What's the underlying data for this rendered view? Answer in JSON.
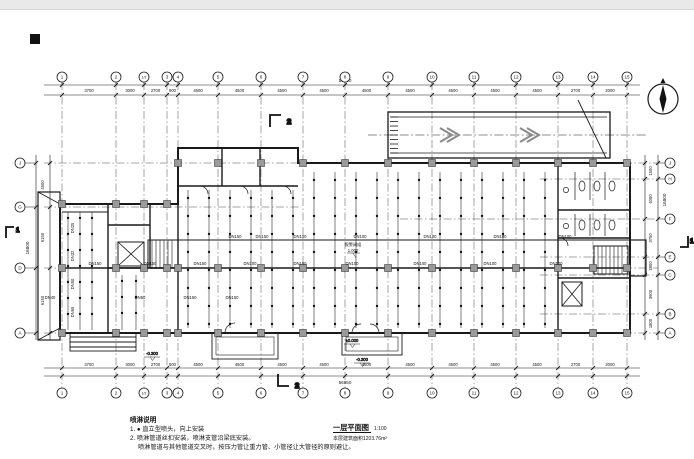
{
  "colors": {
    "ink": "#1a1a1a",
    "grid_line": "#4a4a4a",
    "column_fill": "#9a9a9a",
    "ramp_arrow": "#8a8a8a",
    "topbar": "#e9e9e9",
    "sheet": "#ffffff"
  },
  "axes": {
    "top_labels": [
      "1",
      "2",
      "1/2",
      "3",
      "4",
      "5",
      "6",
      "7",
      "8",
      "9",
      "10",
      "11",
      "12",
      "13",
      "14",
      "15"
    ],
    "top_dims": [
      "3700",
      "3000",
      "2700",
      "900",
      "4500",
      "4500",
      "4500",
      "4500",
      "4500",
      "4500",
      "4500",
      "4500",
      "4500",
      "2700",
      "2000"
    ],
    "top_total": "56950",
    "bottom_total": "56950",
    "left_labels": [
      "J",
      "G",
      "D",
      "A"
    ],
    "left_dims": [
      "4500",
      "6150",
      "6150"
    ],
    "left_total": "16800",
    "right_labels": [
      "J",
      "H",
      "F",
      "E",
      "C",
      "B",
      "A"
    ],
    "right_dims": [
      "1500",
      "4050",
      "3750",
      "1800",
      "3900",
      "1800"
    ],
    "right_total": "16800"
  },
  "pipes": {
    "row1": [
      "DN150",
      "DN150",
      "DN100",
      "DN100",
      "DN100",
      "DN100",
      "DN100"
    ],
    "row2": [
      "DN150",
      "DN150",
      "DN150",
      "DN100",
      "DN100",
      "DN100",
      "DN100",
      "DN100",
      "DN100"
    ],
    "left_row": [
      "DN40",
      "DN50",
      "DN150",
      "DN150"
    ],
    "left_branch": [
      "DN25",
      "DN32",
      "DN50",
      "DN65"
    ],
    "riser_label": "报警阀组",
    "riser_level": "1.000"
  },
  "levels": {
    "entry_zero": "±0.000",
    "entry_minus": "-0.300"
  },
  "sections": {
    "s1": "1",
    "s2": "2"
  },
  "notes": {
    "heading": "喷淋说明",
    "line1": "1. ● 直立型喷头，向上安装",
    "line2": "2. 喷淋管道丝扣安装，喷淋支管沿梁底安装。",
    "line3": "喷淋管道与其他管道交叉时，按压力管让重力管、小管径让大管径的原则避让。"
  },
  "titleblock": {
    "title": "一层平面图",
    "scale": "1:100",
    "area": "本层建筑面积1203.76m²"
  }
}
